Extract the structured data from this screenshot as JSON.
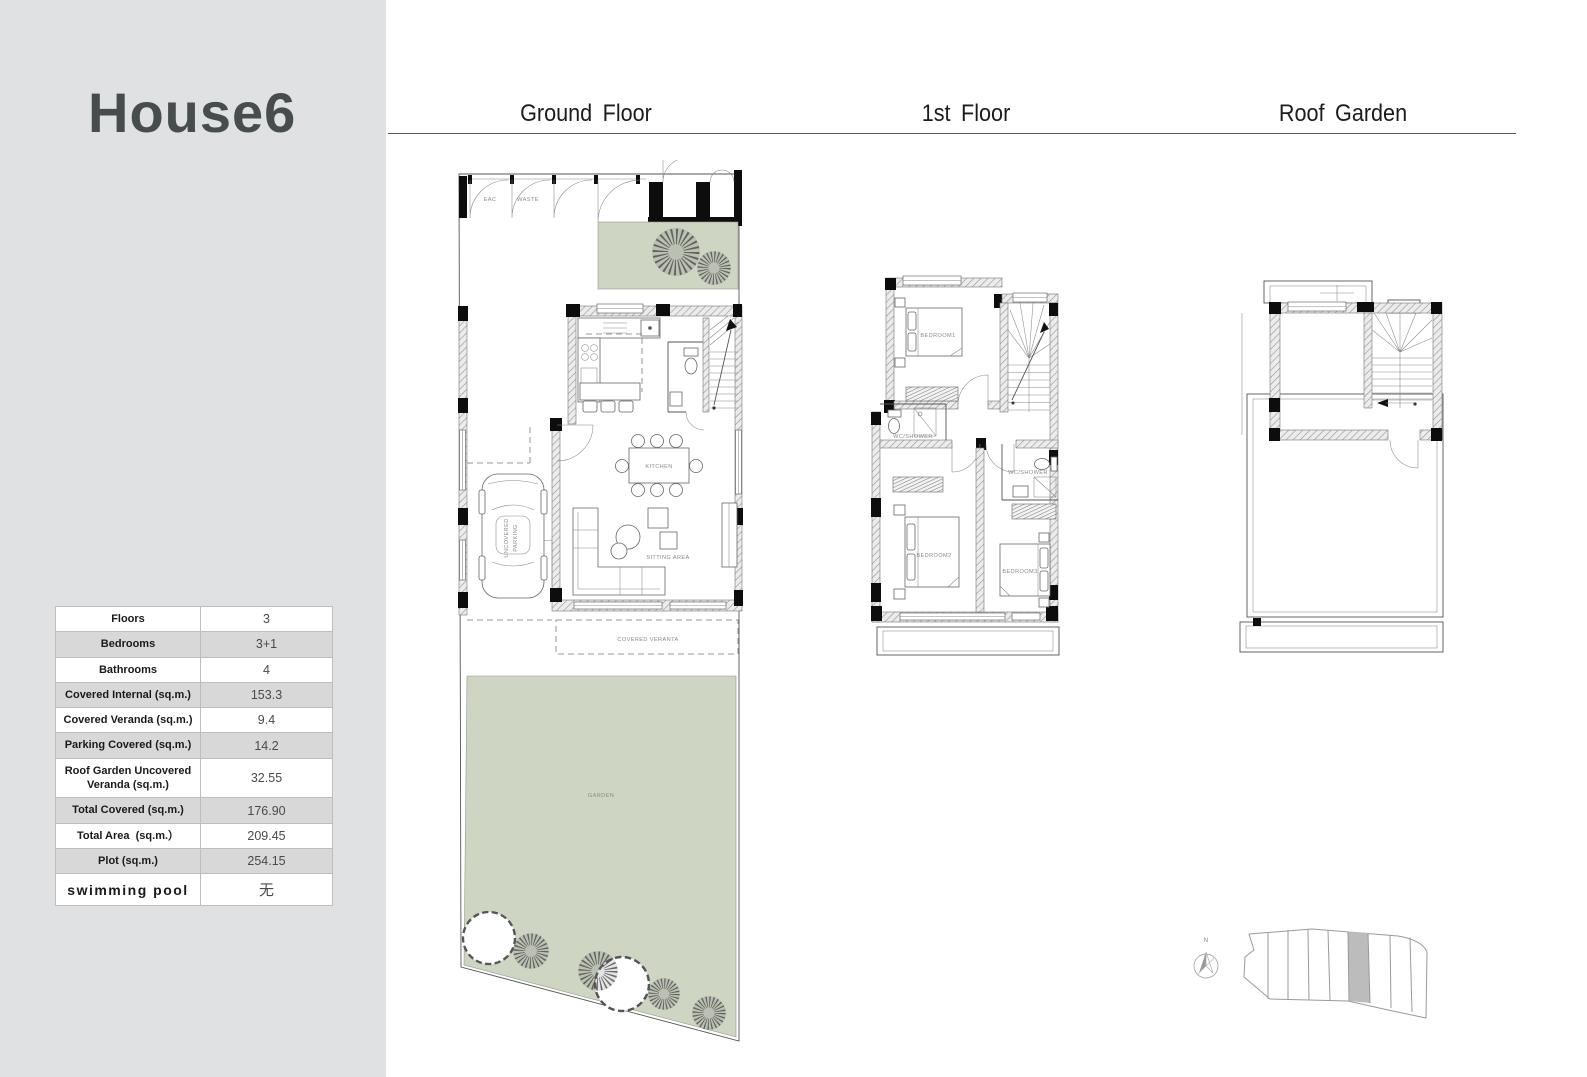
{
  "title": "House6",
  "headers": {
    "ground": "Ground Floor",
    "first": "1st Floor",
    "roof": "Roof Garden"
  },
  "table": {
    "rows": [
      {
        "label": "Floors",
        "value": "3"
      },
      {
        "label": "Bedrooms",
        "value": "3+1"
      },
      {
        "label": "Bathrooms",
        "value": "4"
      },
      {
        "label": "Covered Internal (sq.m.)",
        "value": "153.3"
      },
      {
        "label": "Covered Veranda (sq.m.)",
        "value": "9.4"
      },
      {
        "label": "Parking Covered (sq.m.)",
        "value": "14.2"
      },
      {
        "label": "Roof Garden Uncovered Veranda (sq.m.)",
        "value": "32.55"
      },
      {
        "label": "Total Covered (sq.m.)",
        "value": "176.90"
      },
      {
        "label": "Total Area  (sq.m.）",
        "value": "209.45"
      },
      {
        "label": "Plot (sq.m.)",
        "value": "254.15"
      },
      {
        "label": "swimming pool",
        "value": "无"
      }
    ]
  },
  "plans": {
    "ground": {
      "eac": "EAC",
      "waste": "WASTE",
      "kitchen_table": "KITCHEN",
      "sitting": "SITTING AREA",
      "parking_line1": "UNCOVERED",
      "parking_line2": "PARKING",
      "veranda": "COVERED VERANTA",
      "garden": "GARDEN"
    },
    "first": {
      "bedroom1": "BEDROOM1",
      "bedroom2": "BEDROOM2",
      "bedroom3": "BEDROOM3",
      "wc_left": "WC/SHOWER",
      "wc_right": "WC/SHOWER"
    },
    "site": {
      "north": "N"
    }
  },
  "colors": {
    "sidebar_gray": "#e0e1e2",
    "table_row_gray": "#d8d8d8",
    "garden_green": "#ced5c2",
    "highlighted_plot_gray": "#bcbcbc"
  }
}
